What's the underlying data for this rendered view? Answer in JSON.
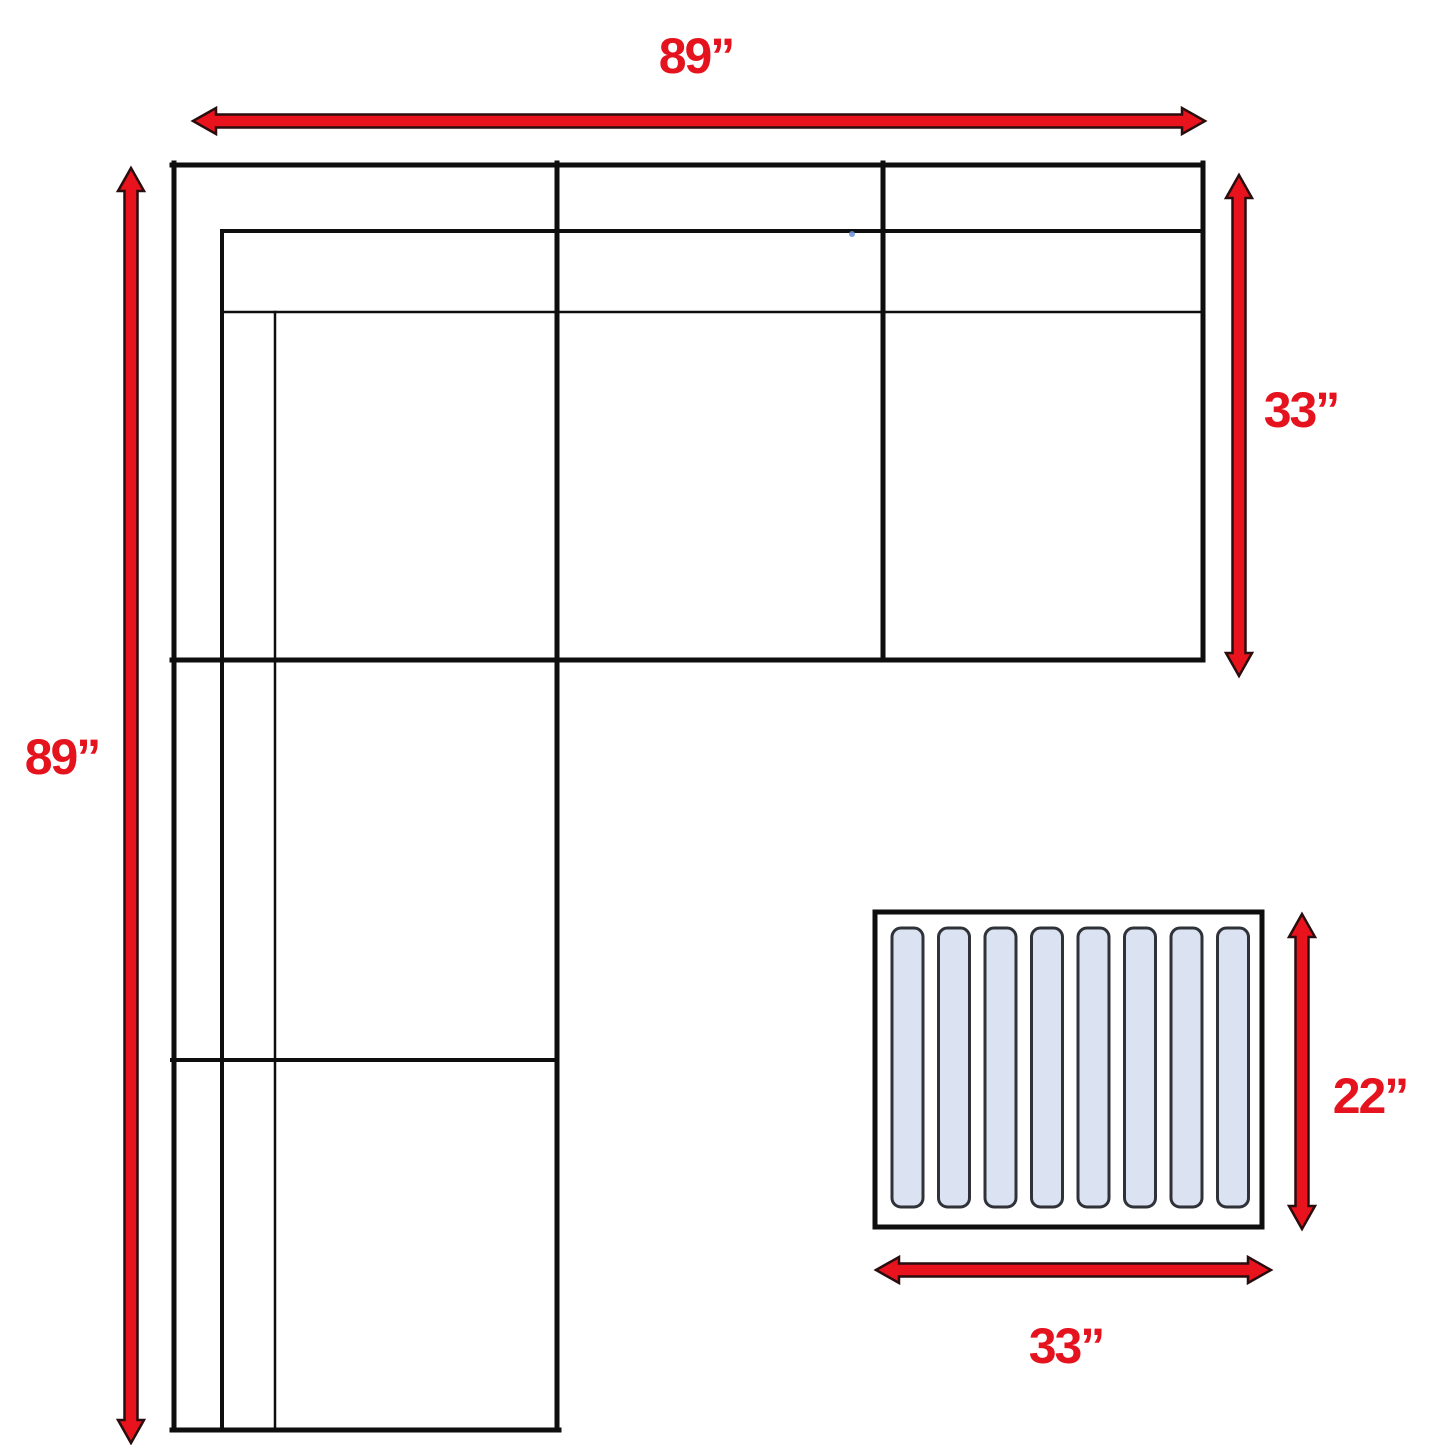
{
  "diagram": {
    "title": "Sectional sofa with ottoman dimension diagram",
    "units": "inches"
  },
  "colors": {
    "background": "#ffffff",
    "line_black": "#0e0e0e",
    "arrow_fill": "#e8131c",
    "arrow_outline": "#2a0d0e",
    "label_red": "#e5131e",
    "slat_fill": "#dbe3f2",
    "slat_border": "#2f3238"
  },
  "dimensions": {
    "sofa_top_width": "89”",
    "sofa_left_height": "89”",
    "sofa_right_depth": "33”",
    "ottoman_height": "22”",
    "ottoman_width": "33”"
  },
  "ottoman": {
    "slat_count": 8
  }
}
